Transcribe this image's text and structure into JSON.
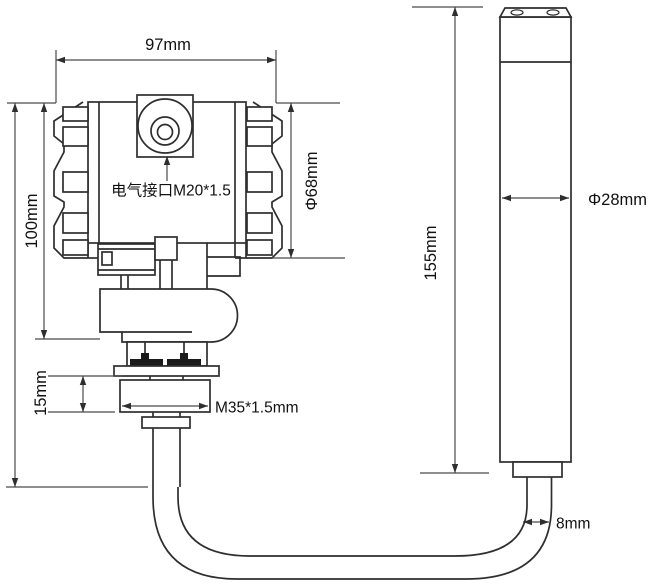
{
  "drawing": {
    "labels": {
      "top_width": "97mm",
      "left_height": "100mm",
      "housing_diameter": "Φ68mm",
      "electrical_interface": "电气接口M20*1.5",
      "mount_height": "15mm",
      "mount_thread": "M35*1.5mm",
      "probe_length": "155mm",
      "probe_diameter": "Φ28mm",
      "cable_diameter": "8mm"
    },
    "colors": {
      "background": "#ffffff",
      "line": "#2e2e2e",
      "dimension": "#4a4a4a",
      "text": "#111111",
      "bolt_fill": "#1a1a1a"
    }
  }
}
